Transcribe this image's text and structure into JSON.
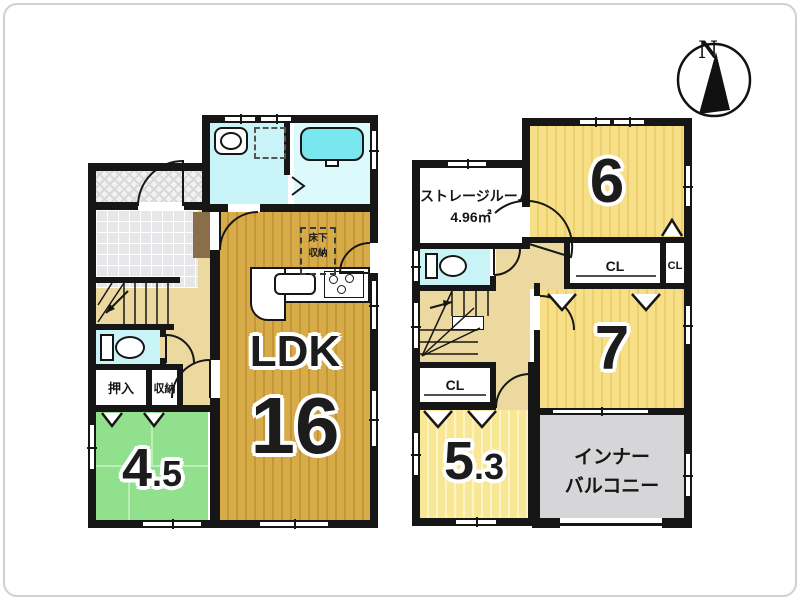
{
  "compass": {
    "north_label": "N"
  },
  "floor1": {
    "ldk": {
      "label": "LDK",
      "size": "16"
    },
    "tatami_room": {
      "size_whole": "4",
      "size_fraction": ".5"
    },
    "closets": {
      "oshiire": "押入",
      "shuno": "収納"
    },
    "underfloor_storage": {
      "line1": "床下",
      "line2": "収納"
    }
  },
  "floor2": {
    "storage_room": {
      "name": "ストレージルーム",
      "area": "4.96㎡"
    },
    "room6": {
      "size": "6"
    },
    "room7": {
      "size": "7"
    },
    "room53": {
      "size_whole": "5",
      "size_fraction": ".3"
    },
    "closets": {
      "cl_center": "CL",
      "cl_right": "CL",
      "cl_left": "CL"
    },
    "inner_balcony": {
      "line1": "インナー",
      "line2": "バルコニー"
    }
  },
  "colors": {
    "wall": "#161616",
    "ldk_floor": "#d8ab49",
    "bedroom_floor": "#f6df87",
    "room53_floor": "#f8e795",
    "tatami_floor": "#90e08e",
    "hallway_floor": "#ecd9a0",
    "entry_tile": "#e7e7ea",
    "balcony_floor": "#d6d6d8",
    "water_floor": "#c9f4f7",
    "bathtub": "#79e8ee",
    "cabinet": "#8a6e49"
  }
}
